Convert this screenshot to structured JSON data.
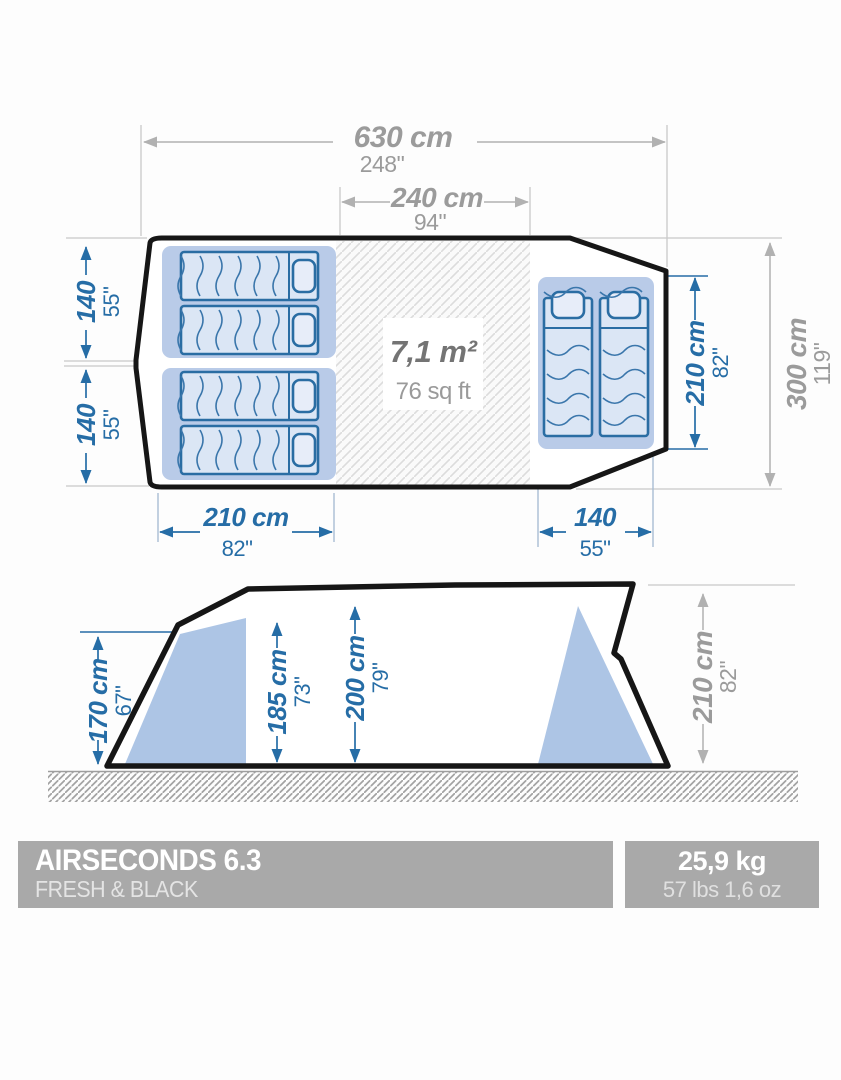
{
  "colors": {
    "accent_blue": "#266da6",
    "dim_gray": "#9b9b9b",
    "outline_black": "#161616",
    "bedroom_fill": "#b9cbe8",
    "bed_fill": "#dbe6f5",
    "side_shape_fill": "#adc5e5",
    "footer_bar_bg": "#a9a9a9"
  },
  "floor_plan": {
    "area": {
      "metric": "7,1 m²",
      "imperial": "76 sq ft"
    },
    "dim_total_width": {
      "metric": "630 cm",
      "imperial": "248\""
    },
    "dim_living_width": {
      "metric": "240 cm",
      "imperial": "94\""
    },
    "dim_total_depth": {
      "metric": "300 cm",
      "imperial": "119\""
    },
    "dim_right_bedroom_depth": {
      "metric": "210 cm",
      "imperial": "82\""
    },
    "dim_left_bedroom_width": {
      "metric": "210 cm",
      "imperial": "82\""
    },
    "dim_right_bedroom_width": {
      "metric": "140",
      "imperial": "55\""
    },
    "dim_left_bedroom_top": {
      "metric": "140",
      "imperial": "55\""
    },
    "dim_left_bedroom_bottom": {
      "metric": "140",
      "imperial": "55\""
    }
  },
  "side_view": {
    "dim_front_height": {
      "metric": "170 cm",
      "imperial": "67\""
    },
    "dim_bedroom_height": {
      "metric": "185 cm",
      "imperial": "73\""
    },
    "dim_living_height": {
      "metric": "200 cm",
      "imperial": "79\""
    },
    "dim_peak_height": {
      "metric": "210 cm",
      "imperial": "82\""
    }
  },
  "footer": {
    "product_name": "AIRSECONDS 6.3",
    "product_line": "FRESH & BLACK",
    "weight_metric": "25,9 kg",
    "weight_imperial": "57 lbs 1,6 oz"
  }
}
